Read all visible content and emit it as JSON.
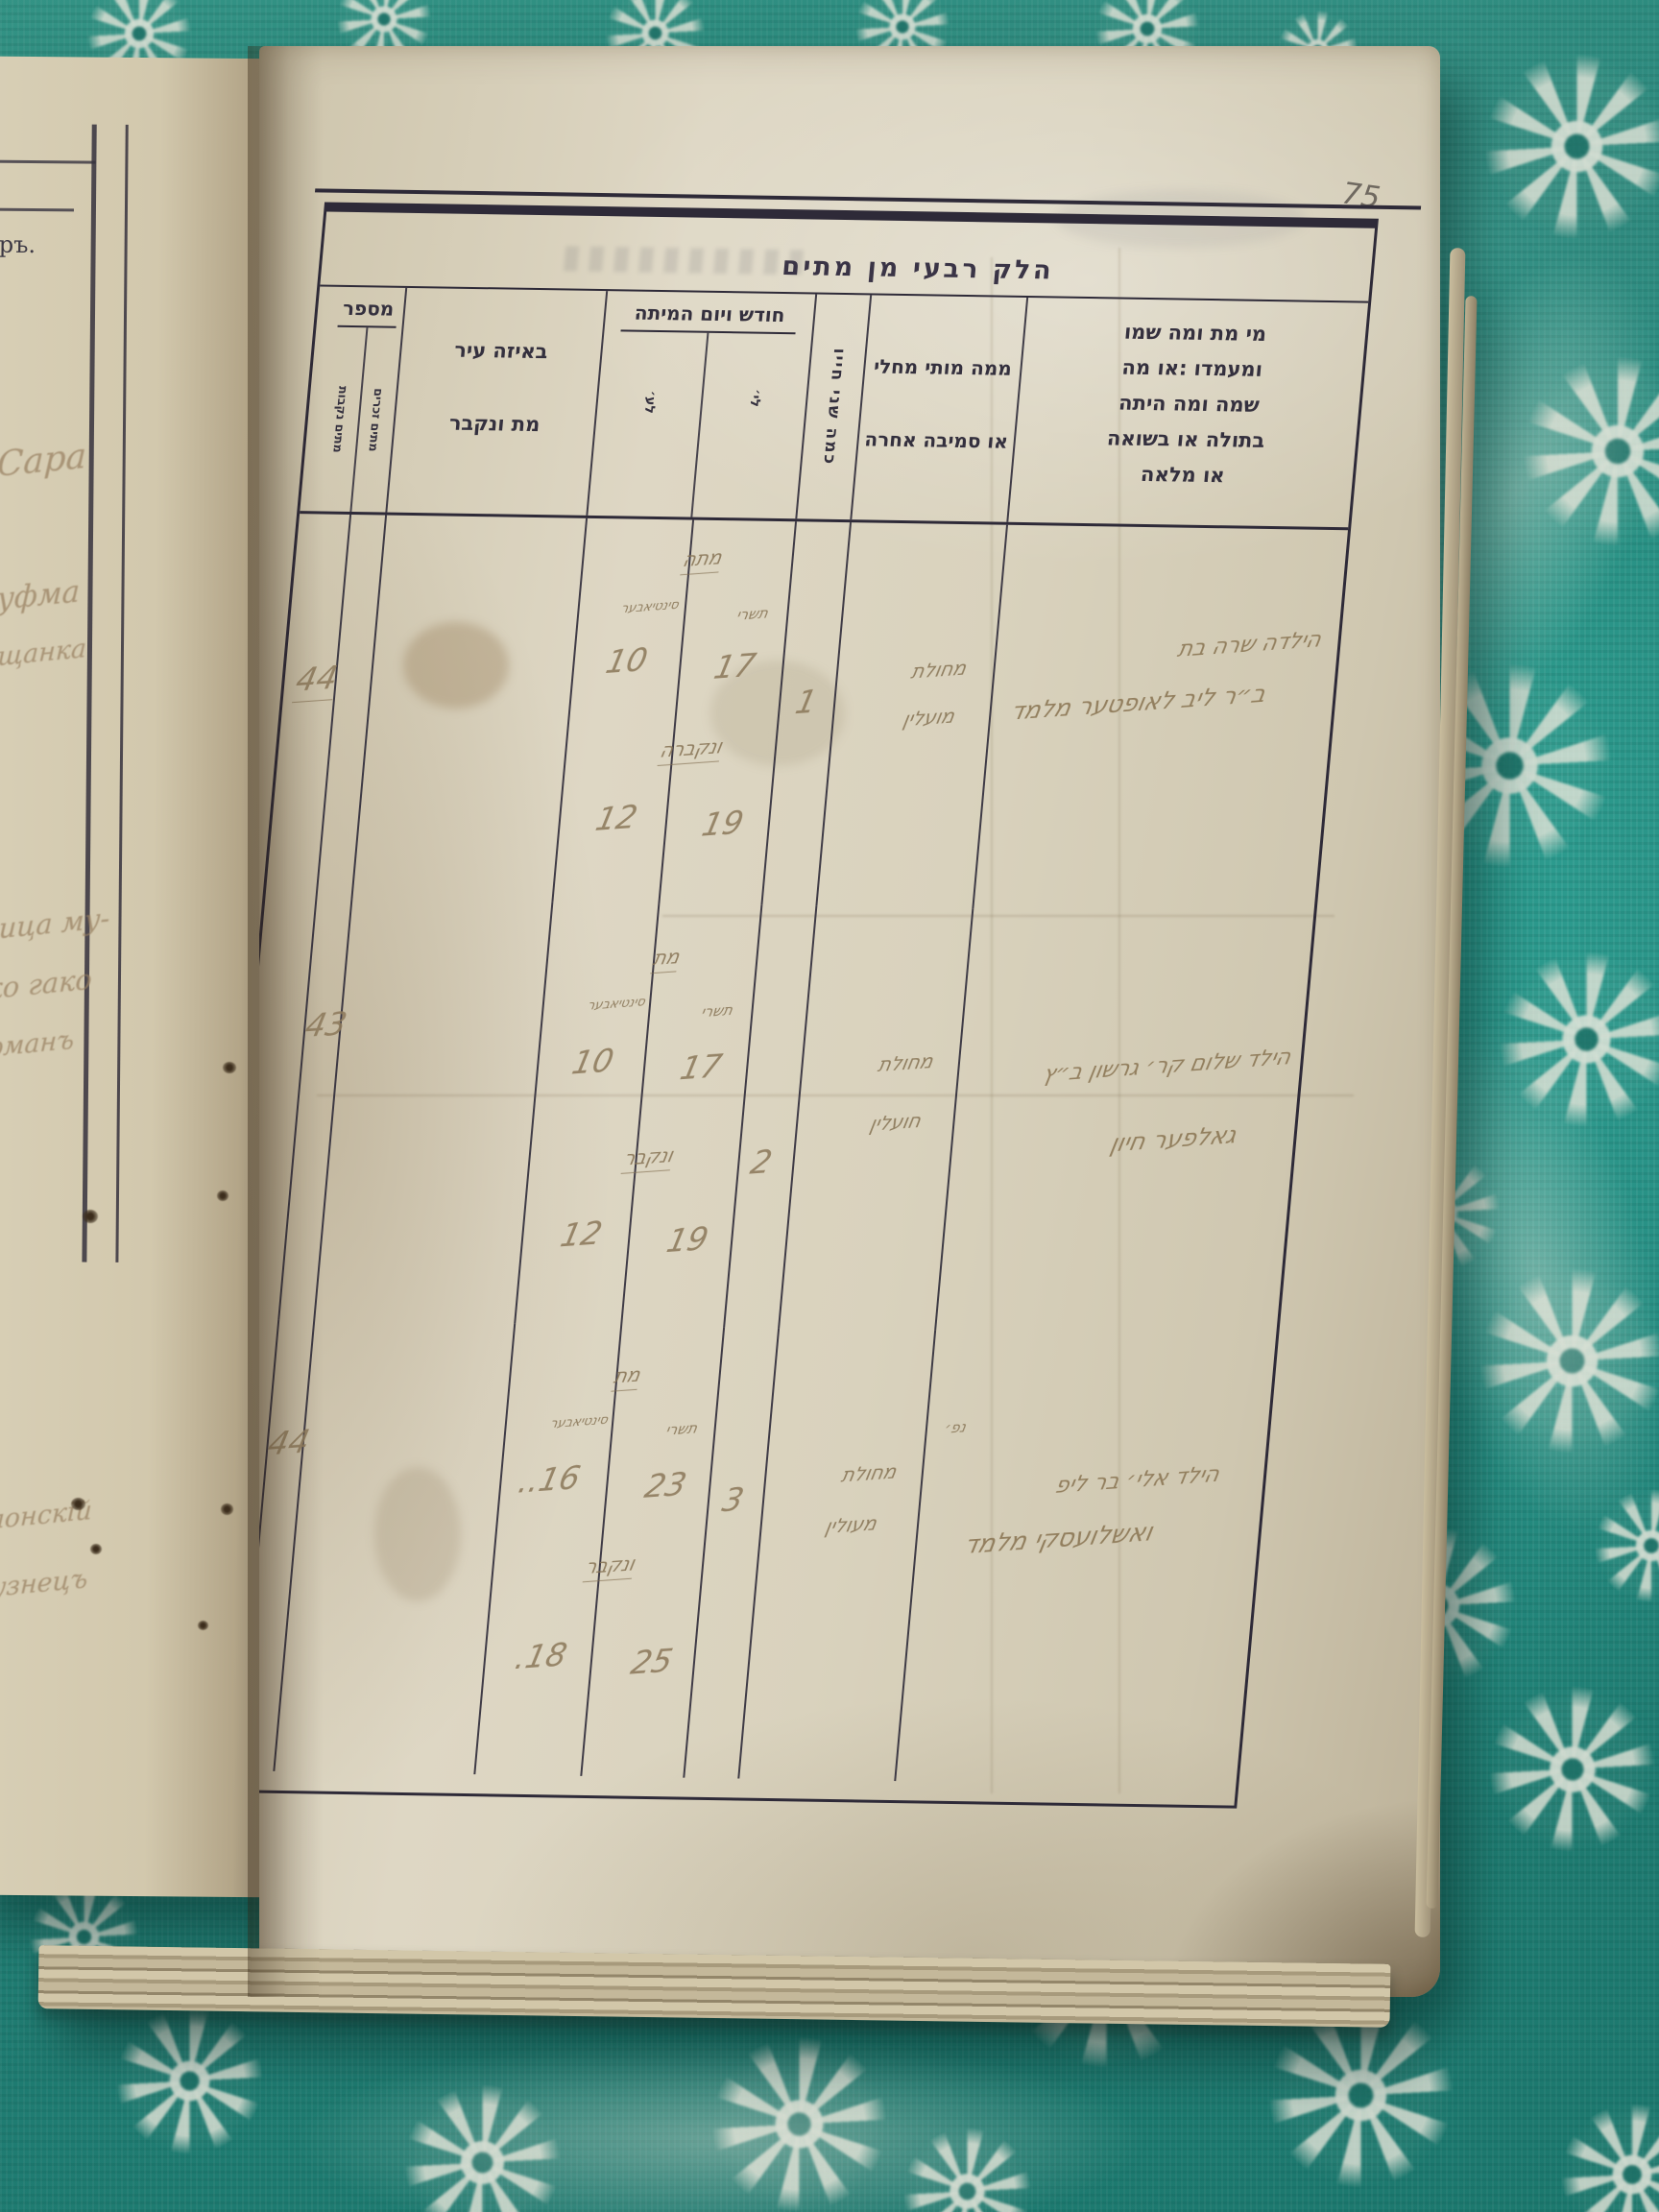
{
  "page_number": "75",
  "title": "הלק רבעי מן מתים",
  "header": {
    "number": {
      "label": "מספר",
      "sub_male": "מתים זכרים",
      "sub_female": "מתים נקבות"
    },
    "city": {
      "line1": "באיזה עיר",
      "line2": "מת ונקבר"
    },
    "date": {
      "label": "חודש ויום המיתה",
      "sub_jewish": "לי׳",
      "sub_civil": "לע׳"
    },
    "age": {
      "label": "כמה שני חייו"
    },
    "cause": {
      "line1": "ממה מותי מחלי",
      "line2": "או סמיבה אחרה"
    },
    "who": {
      "line1": "מי מת ומה שמו",
      "line2": "ומעמדו :או מה",
      "line3": "שמה ומה היתה",
      "line4": "בתולה או בשואה",
      "line5": "או מלאה"
    }
  },
  "entries": [
    {
      "number_male": "",
      "number_female": "44",
      "died_word": "מתה",
      "month_jewish": "תשרי",
      "month_civil": "סינטיאבער",
      "died_day_civil": "10",
      "died_day_jewish": "17",
      "buried_word": "ונקברה",
      "buried_day_civil": "12",
      "buried_day_jewish": "19",
      "age": "1",
      "cause_line1": "מחולת",
      "cause_line2": "מועלין",
      "name_note": "",
      "name_line1": "הילדה שרה בת",
      "name_line2": "ב״ר ליב לאופטער מלמד"
    },
    {
      "number_male": "43",
      "number_female": "",
      "died_word": "מת",
      "month_jewish": "תשרי",
      "month_civil": "סינטיאבער",
      "died_day_civil": "10",
      "died_day_jewish": "17",
      "buried_word": "ונקבר",
      "buried_day_civil": "12",
      "buried_day_jewish": "19",
      "age": "2",
      "cause_line1": "מחולת",
      "cause_line2": "חועלין",
      "name_note": "",
      "name_line1": "הילד שלום קר׳ גרשון ב״ץ",
      "name_line2": "גאלפער חיון"
    },
    {
      "number_male": "44",
      "number_female": "",
      "died_word": "מת",
      "month_jewish": "תשרי",
      "month_civil": "סינטיאבער",
      "died_day_civil": "16..",
      "died_day_jewish": "23",
      "buried_word": "ונקבר",
      "buried_day_civil": "18.",
      "buried_day_jewish": "25",
      "age": "3",
      "cause_line1": "מחולת",
      "cause_line2": "מעולין",
      "name_note": "נפ׳",
      "name_line1": "הילד אלי׳ בר ליפ",
      "name_line2": "ואשלועסקי מלמד"
    }
  ],
  "left_page": {
    "printed_fragment": "еръ.",
    "handwriting": [
      "Сара",
      "Шуфма",
      "мѣщанка",
      "ица му-",
      "тко гако",
      "берманъ",
      "блонскій",
      "узнецъ"
    ]
  }
}
